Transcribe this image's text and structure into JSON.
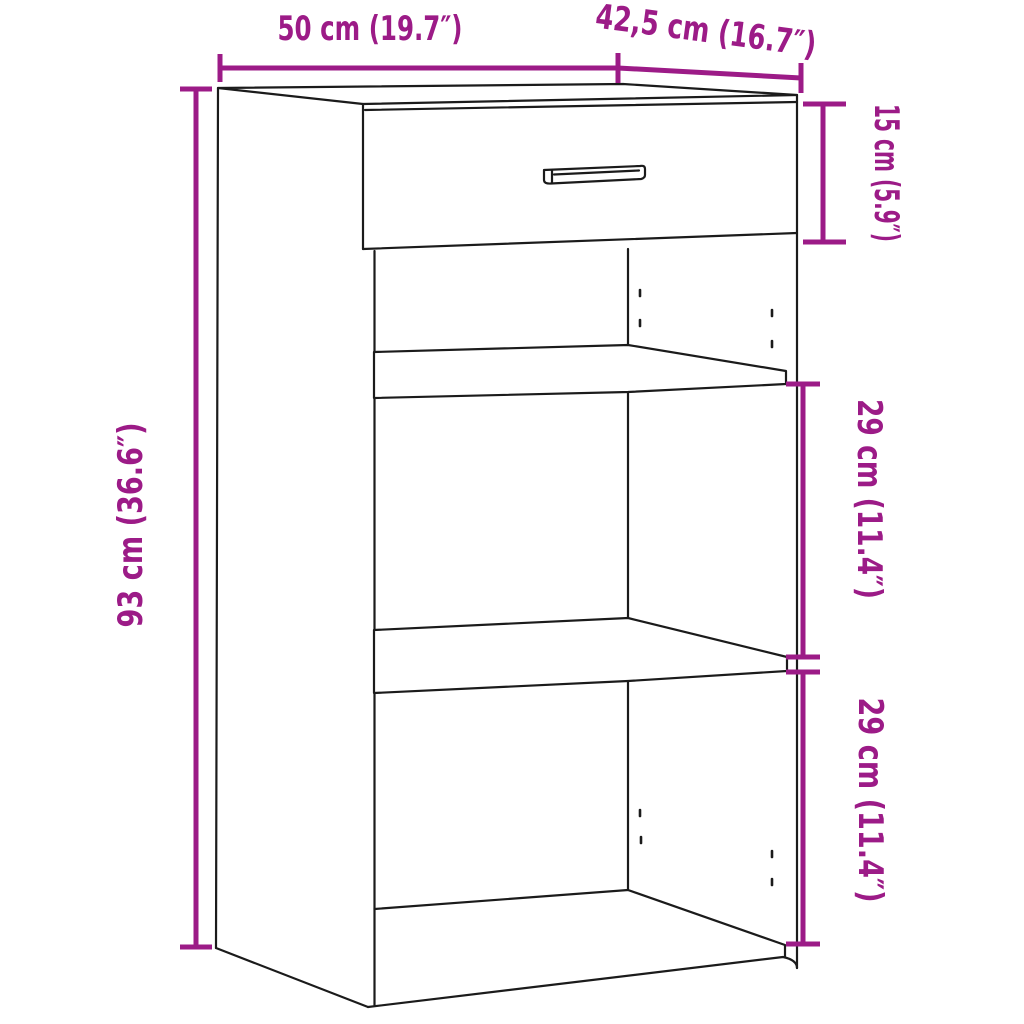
{
  "diagram": {
    "background": "#ffffff",
    "accent_color": "#9C1B87",
    "line_color": "#1b1b1b",
    "subject": "sideboard line drawing with top drawer, two shelves and three open compartments",
    "dimensions": {
      "width": {
        "label": "50 cm (19.7″)"
      },
      "depth": {
        "label": "42,5 cm (16.7″)"
      },
      "drawer": {
        "label": "15 cm (5.9″)"
      },
      "height": {
        "label": "93 cm (36.6″)"
      },
      "upper_shelf": {
        "label": "29 cm (11.4″)"
      },
      "lower_shelf": {
        "label": "29 cm (11.4″)"
      }
    }
  }
}
